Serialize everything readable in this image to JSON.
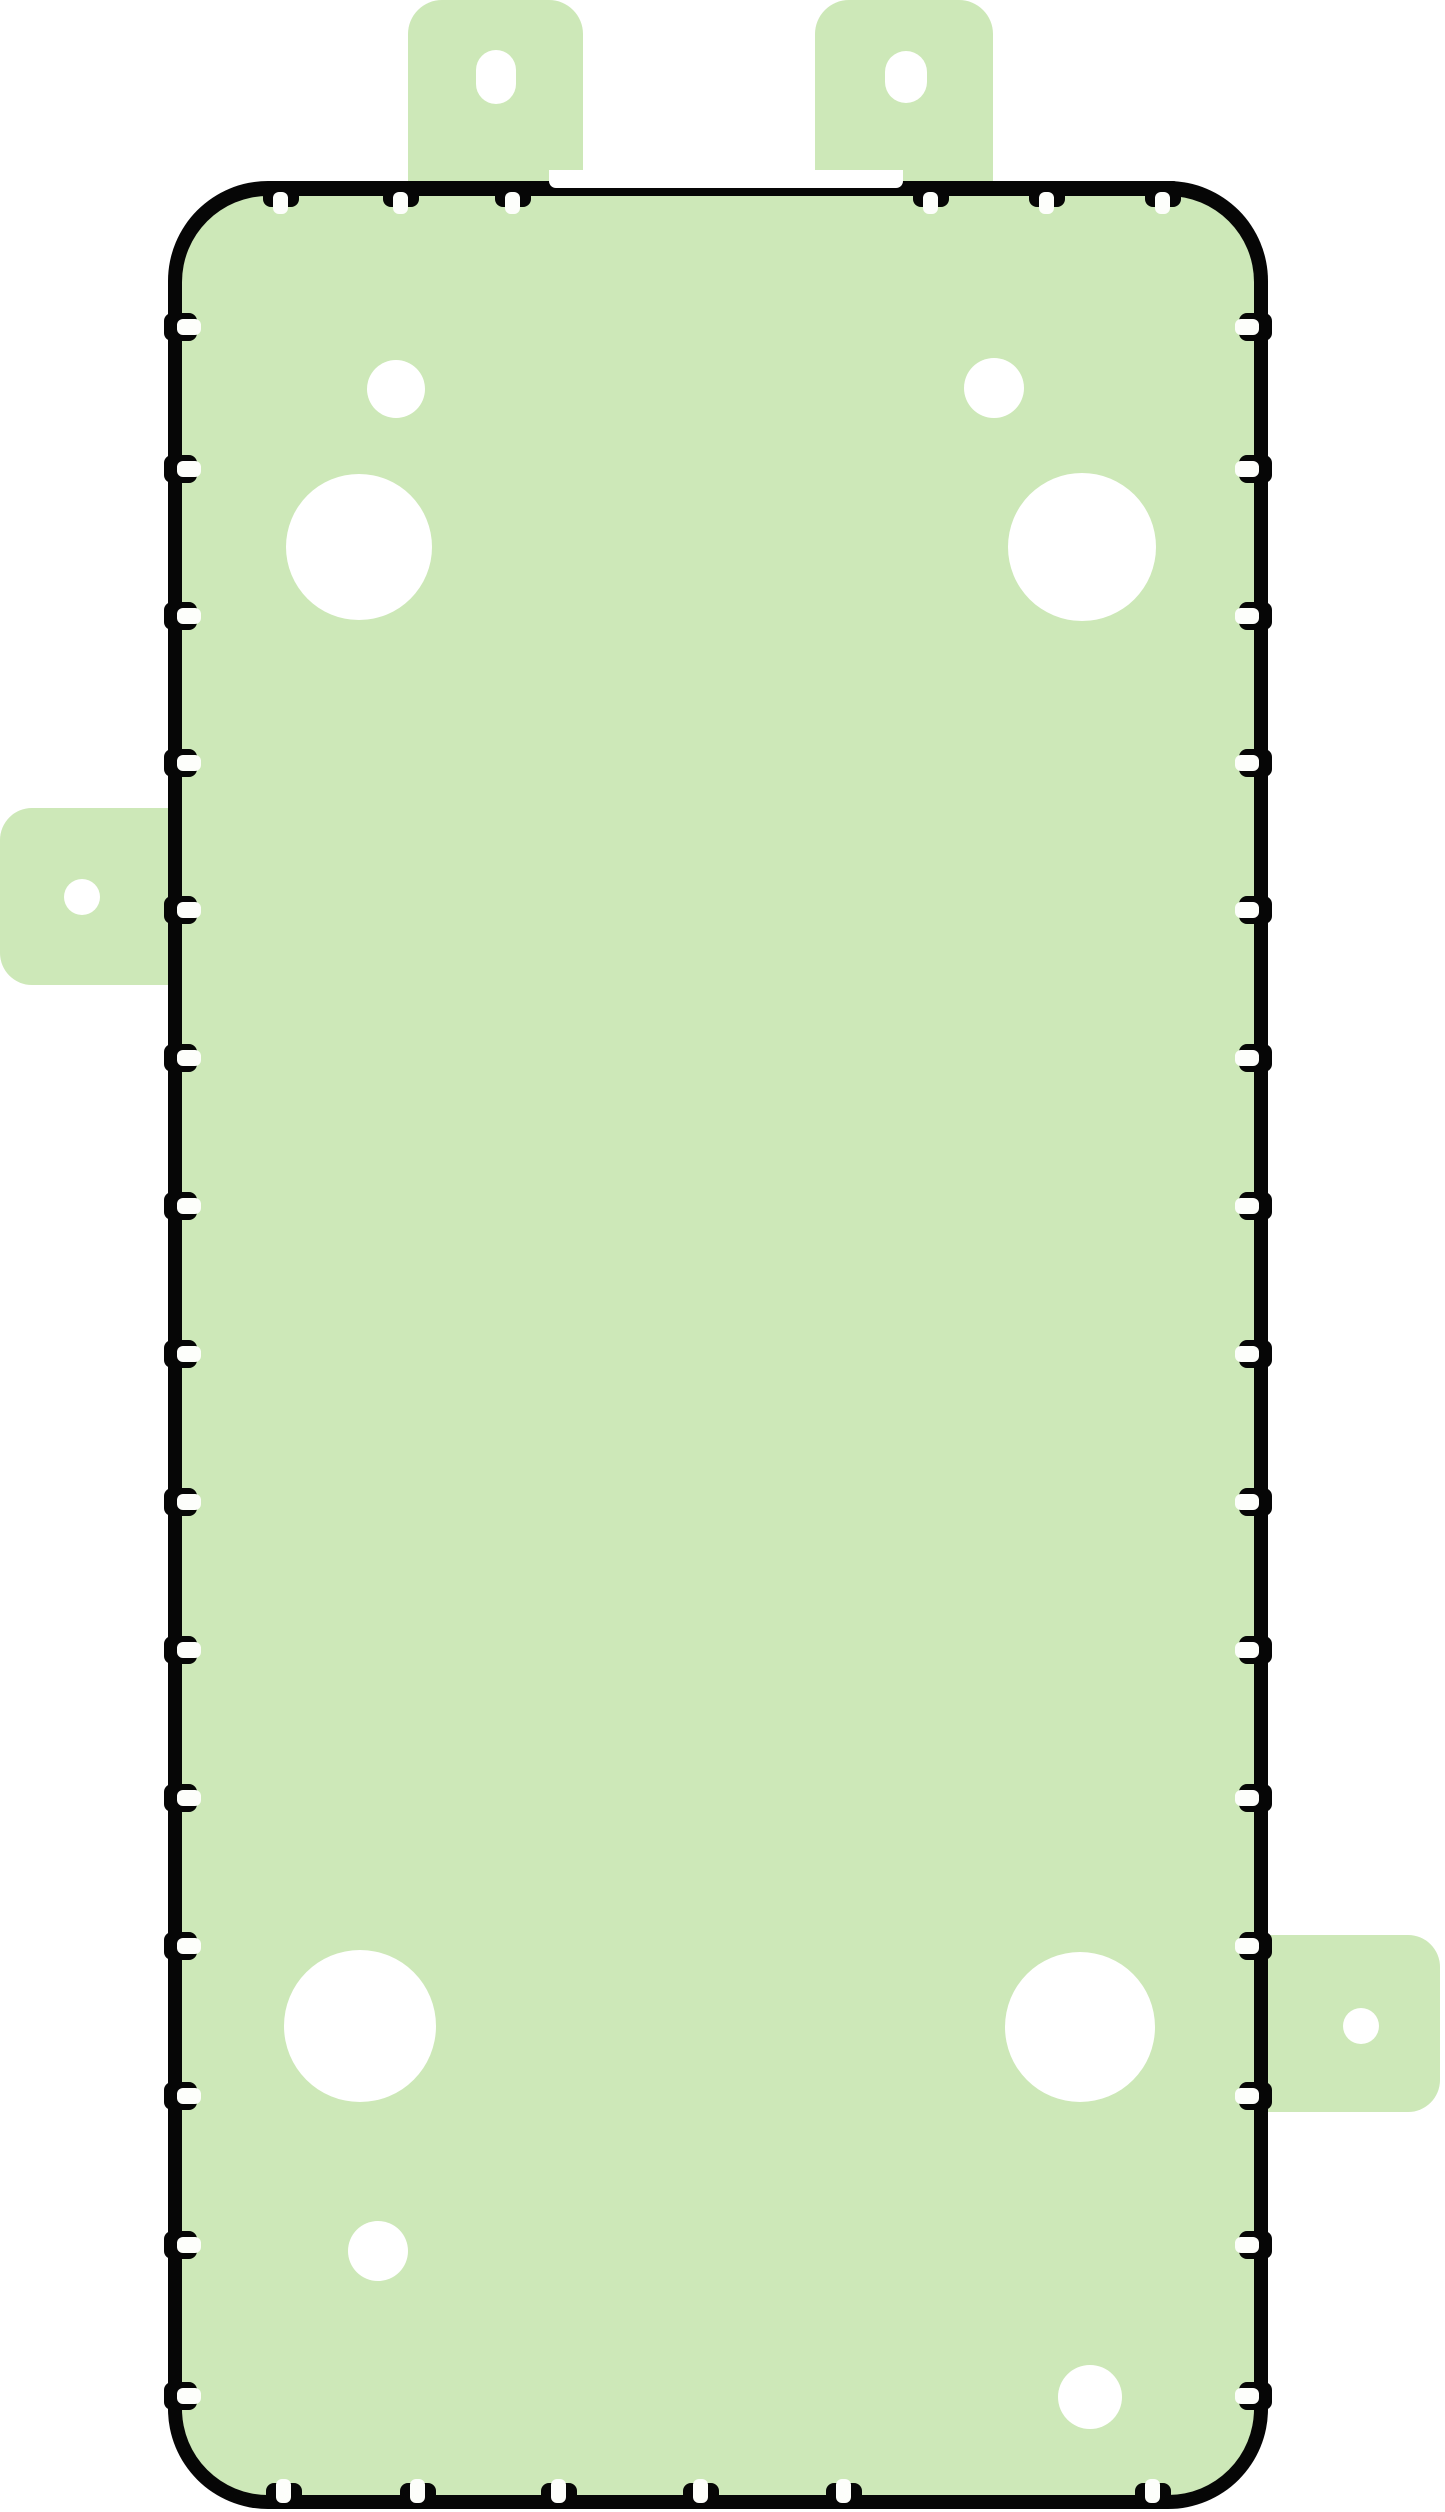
{
  "canvas": {
    "width": 1445,
    "height": 2512,
    "background": "#ffffff"
  },
  "colors": {
    "adhesive_green": "#cde8b8",
    "outline_black": "#060606",
    "cutout_white": "#ffffff",
    "tick_white": "#fdfefb"
  },
  "body_outline": {
    "x": 168,
    "y": 181,
    "w": 1100,
    "h": 2328,
    "outer_radius": 100,
    "border_thickness": 14
  },
  "top_notch_cutout": {
    "x": 549,
    "y": 170,
    "w": 354,
    "h": 18,
    "corner_radius": 7
  },
  "pull_tabs": [
    {
      "name": "pull-tab-top-left",
      "x": 408,
      "y": 0,
      "w": 175,
      "h": 196,
      "corners": "top",
      "radius": 34,
      "hole": {
        "shape": "oval",
        "cx": 496,
        "cy": 77,
        "rx": 20,
        "ry": 27
      }
    },
    {
      "name": "pull-tab-top-right",
      "x": 815,
      "y": 0,
      "w": 178,
      "h": 196,
      "corners": "top",
      "radius": 34,
      "hole": {
        "shape": "oval",
        "cx": 906,
        "cy": 77,
        "rx": 21,
        "ry": 26
      }
    },
    {
      "name": "pull-tab-left",
      "x": 0,
      "y": 808,
      "w": 174,
      "h": 177,
      "corners": "left",
      "radius": 32,
      "hole": {
        "shape": "circle",
        "cx": 82,
        "cy": 897,
        "r": 18
      }
    },
    {
      "name": "pull-tab-right",
      "x": 1262,
      "y": 1935,
      "w": 178,
      "h": 177,
      "corners": "right",
      "radius": 32,
      "hole": {
        "shape": "circle",
        "cx": 1361,
        "cy": 2026,
        "r": 18
      }
    }
  ],
  "cutouts": [
    {
      "name": "cutout-small-top-left",
      "cx": 396,
      "cy": 389,
      "r": 29
    },
    {
      "name": "cutout-small-top-right",
      "cx": 994,
      "cy": 388,
      "r": 30
    },
    {
      "name": "cutout-large-top-left",
      "cx": 359,
      "cy": 547,
      "r": 73
    },
    {
      "name": "cutout-large-top-right",
      "cx": 1082,
      "cy": 547,
      "r": 74
    },
    {
      "name": "cutout-large-bottom-left",
      "cx": 360,
      "cy": 2026,
      "r": 76
    },
    {
      "name": "cutout-large-bottom-right",
      "cx": 1080,
      "cy": 2027,
      "r": 75
    },
    {
      "name": "cutout-small-bottom-left",
      "cx": 378,
      "cy": 2251,
      "r": 30
    },
    {
      "name": "cutout-small-bottom-right",
      "cx": 1090,
      "cy": 2397,
      "r": 32
    }
  ],
  "alignment_ticks": {
    "top_xs": [
      281,
      401,
      513,
      931,
      1047,
      1163
    ],
    "bottom_xs": [
      284,
      418,
      559,
      701,
      844,
      1153
    ],
    "left_ys": [
      327,
      469,
      616,
      763,
      910,
      1058,
      1206,
      1354,
      1502,
      1650,
      1798,
      1946,
      2096,
      2245,
      2396
    ],
    "right_ys": [
      327,
      469,
      616,
      763,
      910,
      1058,
      1206,
      1354,
      1502,
      1650,
      1798,
      1946,
      2096,
      2245,
      2396
    ]
  }
}
